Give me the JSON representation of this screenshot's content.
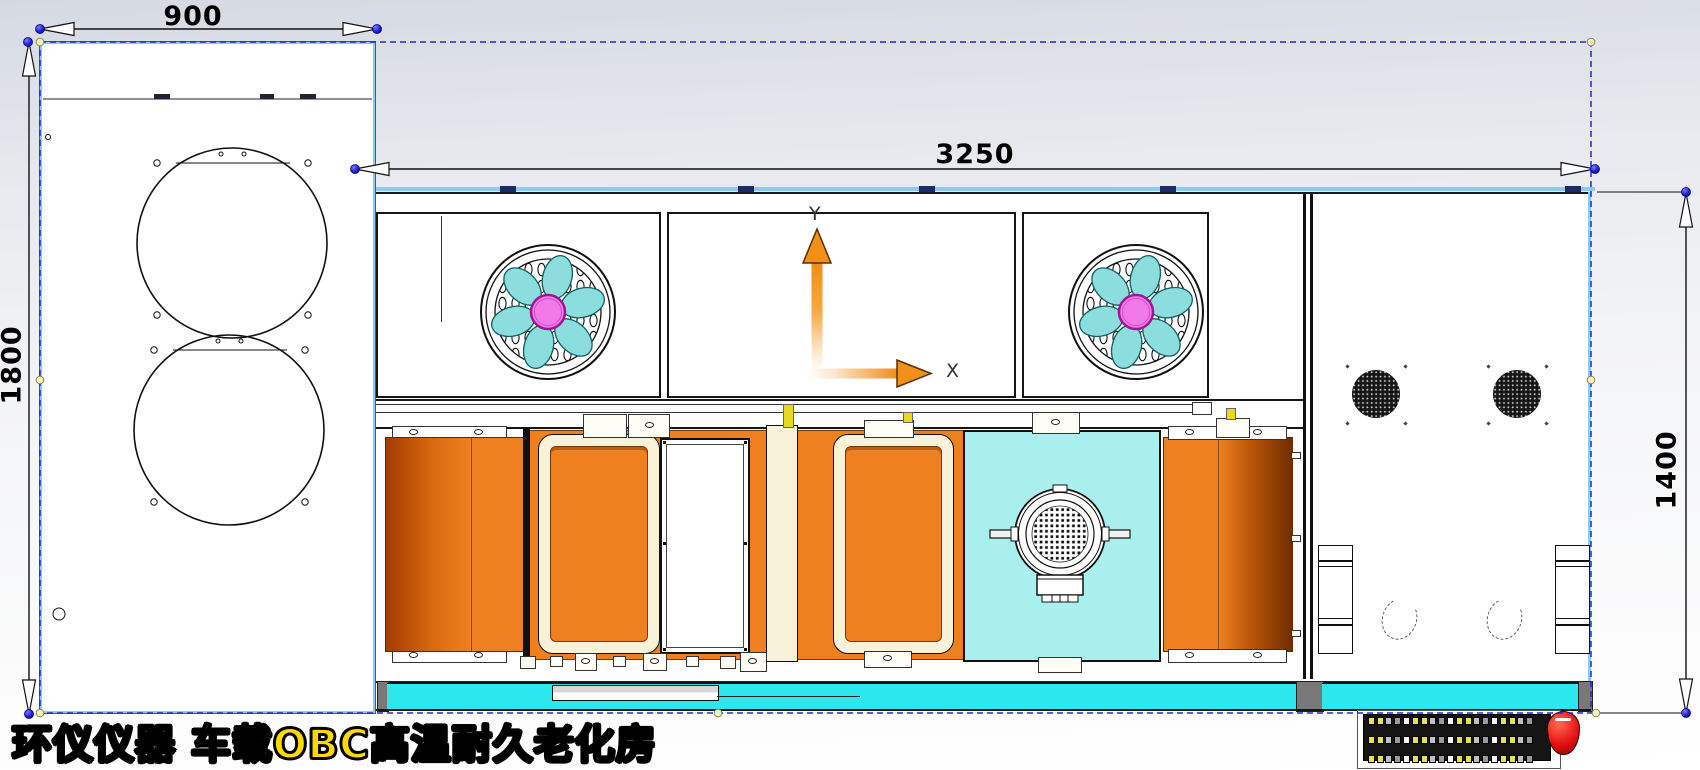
{
  "watermark": {
    "text": "环仪仪器 车载OBC高温耐久老化房"
  },
  "dimensions": {
    "left_unit_width": "900",
    "left_unit_height": "1800",
    "main_unit_width": "3250",
    "main_unit_height": "1400"
  },
  "axes": {
    "x_label": "X",
    "y_label": "Y"
  },
  "colors": {
    "selection_dash_blue": "#2828c8",
    "edge_highlight_blue": "#8fc8f0",
    "dimension_point_blue": "#1414b4",
    "axis_arrow_orange": "#f09018",
    "fan_blade_cyan": "#8cdede",
    "fan_hub_pink": "#f27ae8",
    "heater_orange": "#ef8020",
    "base_strip_cyan": "#2ce8ec",
    "service_panel_cyan": "#a9efee",
    "frame_cream": "#f8f3d8",
    "watermark_yellow": "#ffd900"
  }
}
